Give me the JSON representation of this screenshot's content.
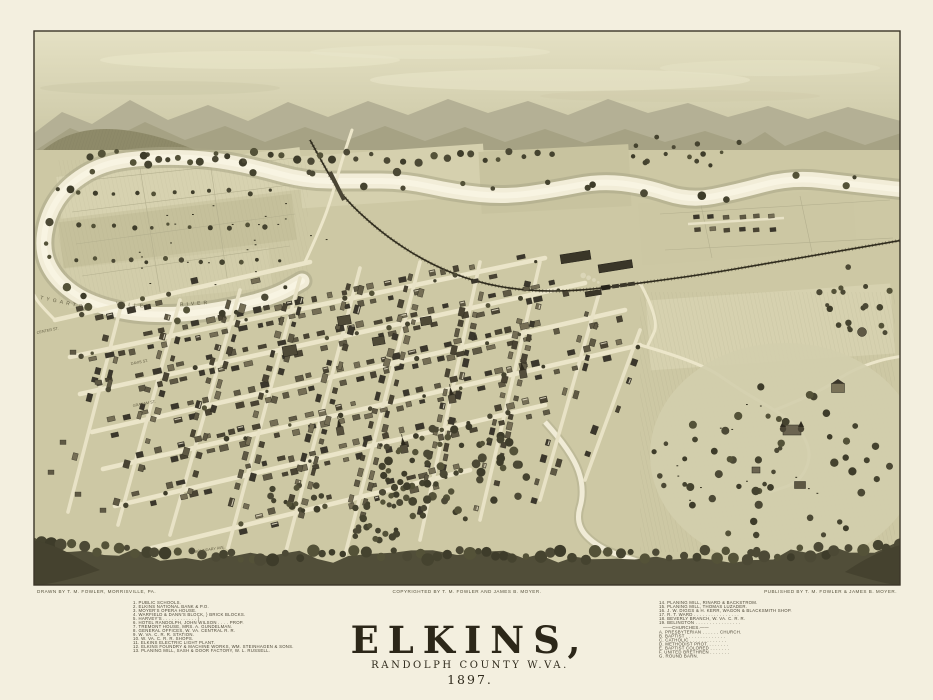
{
  "title_block": {
    "title": "ELKINS,",
    "subtitle": "RANDOLPH COUNTY W.VA.",
    "year": "1897."
  },
  "credits": {
    "drawn": "DRAWN BY T. M. FOWLER, MORRISVILLE, PA.",
    "copyright": "COPYRIGHTED BY T. M. FOWLER AND JAMES B. MOYER.",
    "published": "PUBLISHED BY T. M. FOWLER & JAMES B. MOYER."
  },
  "legend": {
    "left": [
      "1.  PUBLIC SCHOOLS.",
      "2.  ELKINS NATIONAL BANK & P.O.",
      "3.  MOYER'S OPERA HOUSE.",
      "4.  WARFIELD & DANN'S BLOCK, } BRICK BLOCKS.",
      "5.  HARVEY'S . . . . . . . . . . . . }",
      "6.  HOTEL RANDOLPH, JOHN WILSON . . . . PROP.",
      "7.  TREMONT HOUSE, MRS. A. GUNDELMAN.",
      "8.  GENERAL OFFICES, W. VA. CENTRAL R. R.",
      "9.  W. VA. C. R. R. STATION.",
      "10. W. VA. C. R. R. SHOPS.",
      "11. ELKINS ELECTRIC LIGHT PLANT.",
      "12. ELKINS FOUNDRY & MACHINE WORKS, WM. STEINHAGEN & SONS.",
      "13. PLANING MILL, SASH & DOOR FACTORY, W. L. RUSSELL."
    ],
    "right_refs": [
      "14. PLANING MILL, RINARD & BACKSTROM.",
      "15. PLANING MILL, THOMAS LUZADER.",
      "16. J. W. DIGGS & H. KERR, WAGON & BLACKSMITH SHOP.",
      "17. R. T. WARD . . . . . . . . . . . . . . . .",
      "18. BEVERLY BRANCH, W. VA. C. R. R.",
      "19. BELINGTON . . . . . . . . . . . . . . . ."
    ],
    "churches_header": "——CHURCHES.——",
    "churches": [
      "A.  PRESBYTERIAN . . . . . . CHURCH.",
      "B.  BAPTIST . . . . . . . . . . . . . .",
      "C.  CATHOLIC . . . . . . . . . . . . .",
      "D.  METHODIST PROT. . . . . . . .",
      "E.  BAPTIST COLORED . . . . . . .",
      "F.  UNITED BRETHREN . . . . . . .",
      "G.  ROUND BARN."
    ]
  },
  "map_labels": {
    "river_1": "TYGARTS",
    "river_2": "VALLEY",
    "river_3": "RIVER",
    "center_st": "CENTER ST.",
    "davis_st": "DAVIS ST.",
    "graham_st": "GRAHAM ST.",
    "boundary_ave": "BOUNDARY AVE."
  },
  "colors": {
    "paper": "#f3efdf",
    "sky": "#d6d2b2",
    "ridge_far": "#b4b095",
    "ridge_near": "#93906e",
    "valley": "#cdc8a4",
    "river": "#f2edd8",
    "forest": "#4c4935",
    "ink": "#2c2719"
  }
}
